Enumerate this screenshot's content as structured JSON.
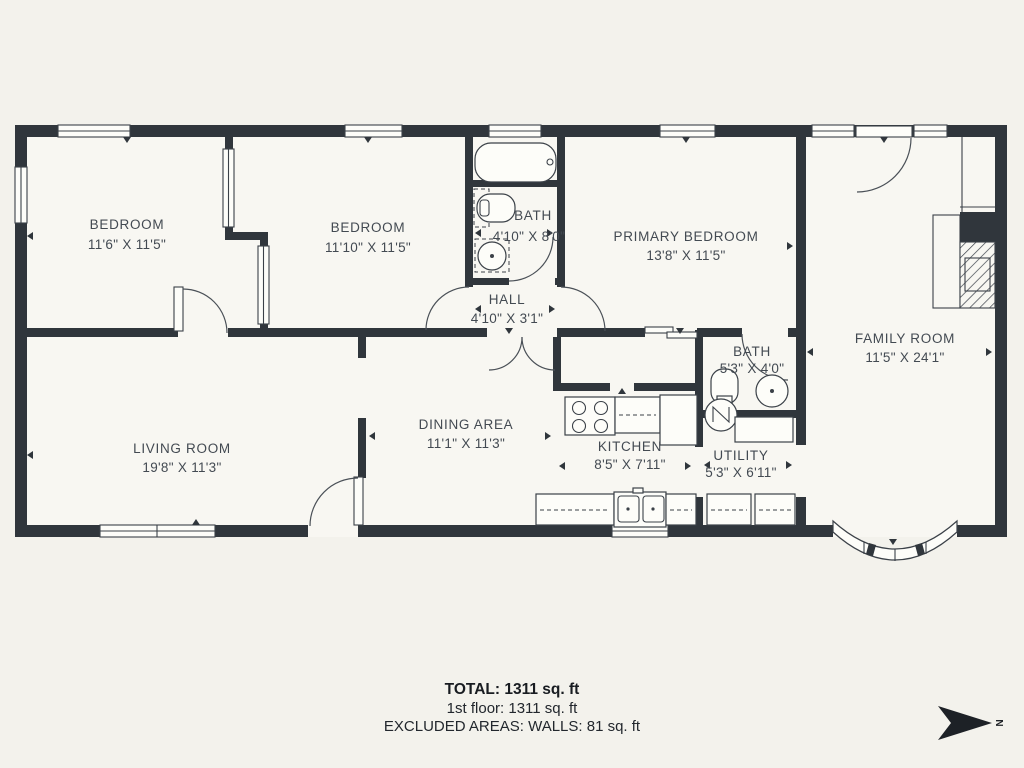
{
  "colors": {
    "background": "#f3f2ec",
    "floor": "#f8f7f2",
    "wall": "#30363c",
    "line": "#3b4148",
    "text": "#434a52"
  },
  "rooms": [
    {
      "name": "BEDROOM",
      "dims": "11'6\" X 11'5\""
    },
    {
      "name": "BEDROOM",
      "dims": "11'10\" X 11'5\""
    },
    {
      "name": "BATH",
      "dims": "4'10\" X 8'0\""
    },
    {
      "name": "HALL",
      "dims": "4'10\" X 3'1\""
    },
    {
      "name": "PRIMARY BEDROOM",
      "dims": "13'8\" X 11'5\""
    },
    {
      "name": "FAMILY ROOM",
      "dims": "11'5\" X 24'1\""
    },
    {
      "name": "LIVING ROOM",
      "dims": "19'8\" X 11'3\""
    },
    {
      "name": "DINING AREA",
      "dims": "11'1\" X 11'3\""
    },
    {
      "name": "KITCHEN",
      "dims": "8'5\" X 7'11\""
    },
    {
      "name": "BATH",
      "dims": "5'3\" X 4'0\""
    },
    {
      "name": "UTILITY",
      "dims": "5'3\" X 6'11\""
    }
  ],
  "summary": {
    "total": "TOTAL: 1311 sq. ft",
    "floor": "1st floor: 1311 sq. ft",
    "excluded": "EXCLUDED AREAS: WALLS: 81 sq. ft"
  },
  "compass": {
    "label": "N"
  }
}
